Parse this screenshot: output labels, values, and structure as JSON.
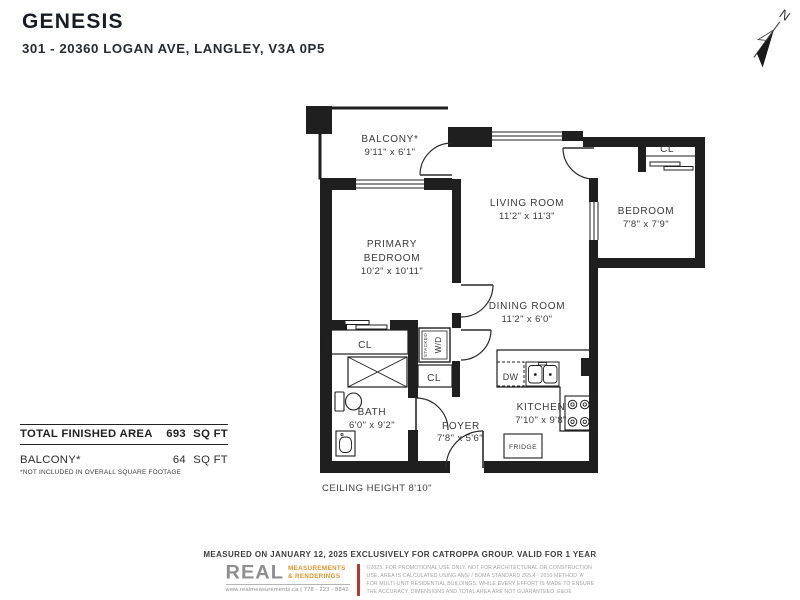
{
  "header": {
    "title": "GENESIS",
    "address": "301 - 20360 LOGAN AVE, LANGLEY, V3A 0P5"
  },
  "compass": {
    "north": "N"
  },
  "rooms": {
    "balcony": {
      "name": "BALCONY*",
      "dims": "9'11\" x 6'1\""
    },
    "primary_bedroom": {
      "line1": "PRIMARY",
      "line2": "BEDROOM",
      "dims": "10'2\" x 10'11\""
    },
    "living_room": {
      "name": "LIVING ROOM",
      "dims": "11'2\" x 11'3\""
    },
    "bedroom": {
      "name": "BEDROOM",
      "dims": "7'8\" x 7'9\""
    },
    "dining_room": {
      "name": "DINING ROOM",
      "dims": "11'2\" x 6'0\""
    },
    "kitchen": {
      "name": "KITCHEN",
      "dims": "7'10\" x 9'8\""
    },
    "bath": {
      "name": "BATH",
      "dims": "6'0\" x 9'2\""
    },
    "foyer": {
      "name": "FOYER",
      "dims": "7'8\" x 5'6\""
    }
  },
  "labels": {
    "closet": "CL",
    "dishwasher": "DW",
    "fridge": "FRIDGE",
    "stacked": "STACKED",
    "washer_dryer": "W/D",
    "ceiling_note": "CEILING HEIGHT 8'10\""
  },
  "area_table": {
    "rows": [
      {
        "label": "TOTAL FINISHED AREA",
        "value": "693",
        "unit": "SQ FT"
      },
      {
        "label": "BALCONY*",
        "value": "64",
        "unit": "SQ FT"
      }
    ],
    "footnote": "*NOT INCLUDED IN OVERALL SQUARE FOOTAGE"
  },
  "footer": {
    "measured_line": "MEASURED ON JANUARY 12, 2025 EXCLUSIVELY FOR CATROPPA GROUP. VALID FOR 1 YEAR",
    "logo": {
      "name": "REAL",
      "sub1": "MEASUREMENTS",
      "sub2": "&  RENDERINGS",
      "contact": "www.realmeasurements.ca | 778 - 223 - 8842"
    },
    "disclaimer": [
      "©2025. FOR PROMOTIONAL USE ONLY. NOT FOR ARCHITECTURAL OR CONSTRUCTION",
      "USE. AREA IS CALCULATED USING ANSI / BOMA STANDARD Z65.4 - 2010 METHOD 'A'",
      "FOR MULTI-UNIT RESIDENTIAL BUILDINGS. WHILE EVERY EFFORT IS MADE TO ENSURE",
      "THE ACCURACY, DIMENSIONS AND TOTAL AREA ARE NOT GUARANTEED. E&OE"
    ]
  },
  "colors": {
    "wall": "#1f1f1f",
    "label_text": "#3a3a3a",
    "logo_gray": "#8f8f8f",
    "logo_orange": "#e2932c",
    "divider_red": "#b23a30",
    "disclaimer_gray": "#a3a3a3"
  }
}
